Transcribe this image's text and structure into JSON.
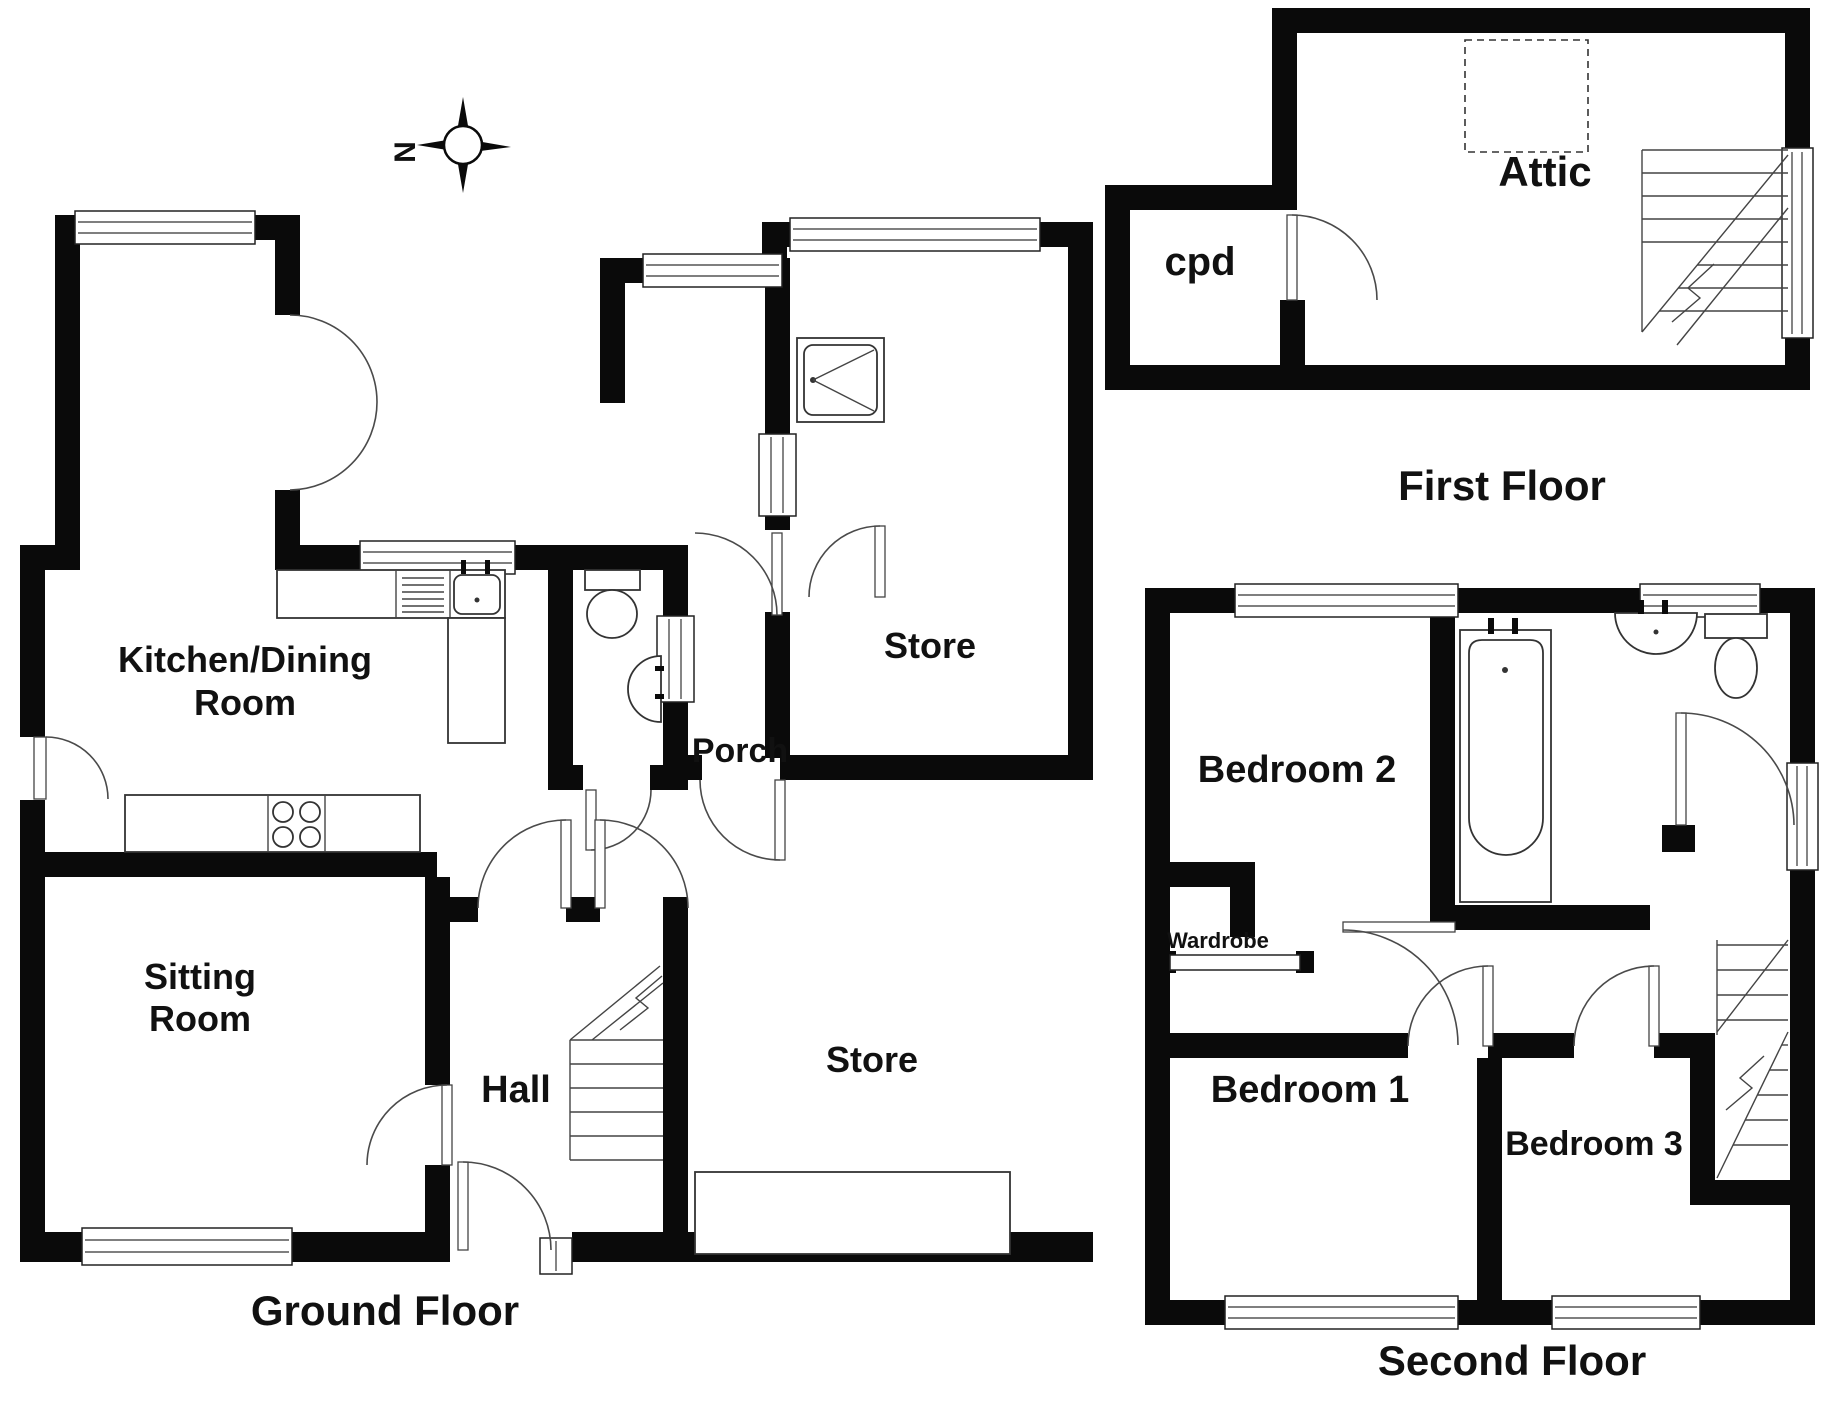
{
  "document": {
    "type": "Property floor plan"
  },
  "colors": {
    "wall": "#0a0a0a",
    "background": "#ffffff",
    "text": "#111111"
  },
  "compass": {
    "north_label": "N"
  },
  "ground_floor": {
    "title": "Ground Floor",
    "rooms": {
      "kitchen_dining_line1": "Kitchen/Dining",
      "kitchen_dining_line2": "Room",
      "sitting_line1": "Sitting",
      "sitting_line2": "Room",
      "hall": "Hall",
      "porch": "Porch",
      "store_front": "Store",
      "store_rear": "Store"
    }
  },
  "first_floor": {
    "title": "First Floor",
    "rooms": {
      "attic": "Attic",
      "cupboard": "cpd"
    }
  },
  "second_floor": {
    "title": "Second Floor",
    "rooms": {
      "bedroom1": "Bedroom 1",
      "bedroom2": "Bedroom 2",
      "bedroom3": "Bedroom 3",
      "wardrobe": "Wardrobe"
    }
  }
}
